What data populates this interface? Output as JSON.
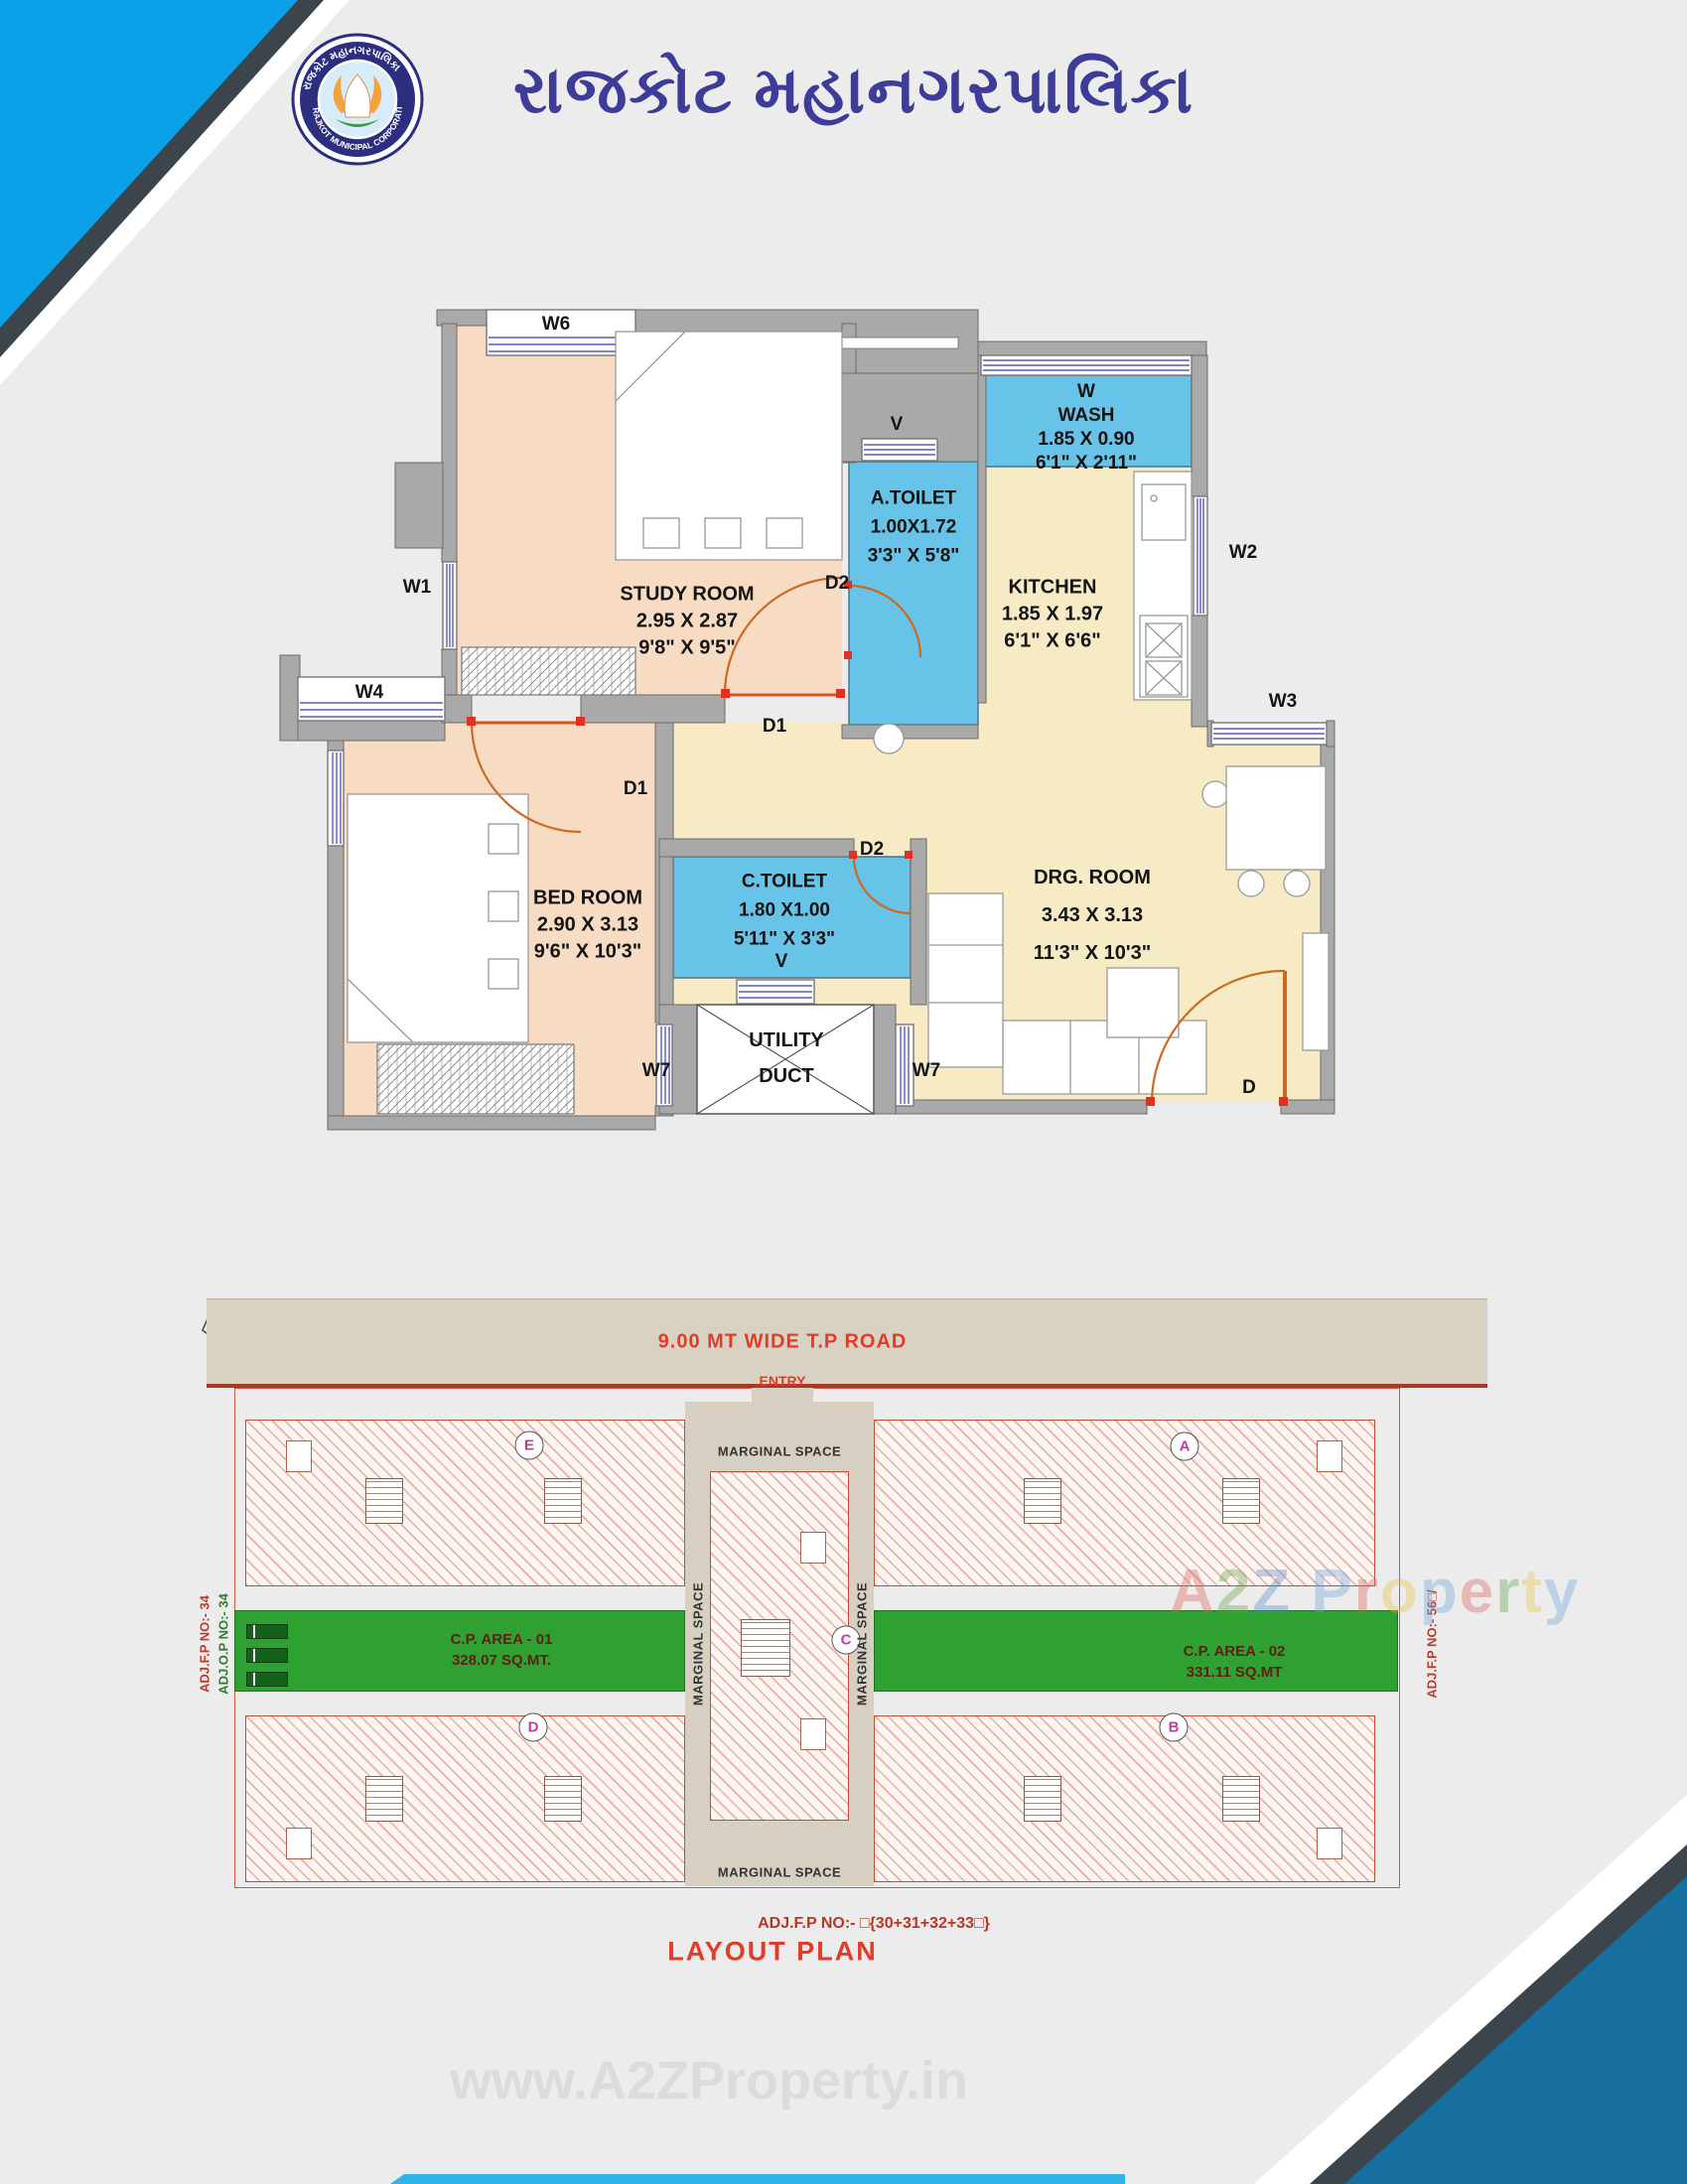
{
  "header": {
    "title": "રાજકોટ મહાનગરપાલિકા",
    "logo": {
      "arc_top": "રાજકોટ મહાનગરપાલિકા",
      "arc_bottom": "RAJKOT MUNICIPAL CORPORATION"
    }
  },
  "unit_plan": {
    "rooms": {
      "study": {
        "name": "STUDY ROOM",
        "dim_m": "2.95 X 2.87",
        "dim_ft": "9'8\" X 9'5\""
      },
      "bed": {
        "name": "BED ROOM",
        "dim_m": "2.90 X 3.13",
        "dim_ft": "9'6\" X 10'3\""
      },
      "a_toilet": {
        "name": "A.TOILET",
        "dim_m": "1.00X1.72",
        "dim_ft": "3'3\" X 5'8\""
      },
      "c_toilet": {
        "name": "C.TOILET",
        "dim_m": "1.80 X1.00",
        "dim_ft": "5'11\" X 3'3\""
      },
      "wash": {
        "tag": "W",
        "name": "WASH",
        "dim_m": "1.85 X 0.90",
        "dim_ft": "6'1\" X 2'11\""
      },
      "kitchen": {
        "name": "KITCHEN",
        "dim_m": "1.85 X 1.97",
        "dim_ft": "6'1\" X 6'6\""
      },
      "drg": {
        "name": "DRG. ROOM",
        "dim_m": "3.43 X 3.13",
        "dim_ft": "11'3\" X 10'3\""
      },
      "utility": {
        "line1": "UTILITY",
        "line2": "DUCT"
      }
    },
    "tags": {
      "w1": "W1",
      "w2": "W2",
      "w3": "W3",
      "w4": "W4",
      "w6": "W6",
      "w7": "W7",
      "v": "V",
      "d": "D",
      "d1": "D1",
      "d2": "D2"
    }
  },
  "layout_plan": {
    "road": "9.00 MT WIDE T.P ROAD",
    "entry": "ENTRY",
    "marginal": "MARGINAL SPACE",
    "cp1": {
      "line1": "C.P. AREA - 01",
      "line2": "328.07 SQ.MT."
    },
    "cp2": {
      "line1": "C.P. AREA - 02",
      "line2": "331.11 SQ.MT"
    },
    "adj_left_red": "ADJ.F.P NO:- 34",
    "adj_left_green": "ADJ.O.P NO:- 34",
    "adj_right": "ADJ.F.P NO:- 56□/",
    "adj_bottom": "ADJ.F.P NO:- □{30+31+32+33□}",
    "title": "LAYOUT PLAN",
    "blocks": {
      "a": "A",
      "b": "B",
      "c": "C",
      "d": "D",
      "e": "E"
    }
  },
  "watermark": {
    "brand": [
      {
        "ch": "A",
        "color": "#e0635e"
      },
      {
        "ch": "2",
        "color": "#69a84f"
      },
      {
        "ch": "Z",
        "color": "#5b8fd4"
      },
      {
        "ch": " ",
        "color": "#888888"
      },
      {
        "ch": "P",
        "color": "#6fa8dc"
      },
      {
        "ch": "r",
        "color": "#e0635e"
      },
      {
        "ch": "o",
        "color": "#e8c44a"
      },
      {
        "ch": "p",
        "color": "#6fa8dc"
      },
      {
        "ch": "e",
        "color": "#e0635e"
      },
      {
        "ch": "r",
        "color": "#69a84f"
      },
      {
        "ch": "t",
        "color": "#e8c44a"
      },
      {
        "ch": "y",
        "color": "#6fa8dc"
      }
    ],
    "site": "www.A2ZProperty.in"
  },
  "colors": {
    "accent_blue": "#0aa1e8",
    "dark_blue": "#166f9e",
    "title_blue": "#3d3c99",
    "red": "#e23c28",
    "green_area": "#2fa032",
    "toilet_blue": "#68c3e8",
    "room_peach": "#f8dbc3",
    "room_cream": "#f6ebc4",
    "wall_gray": "#a9a9a9"
  }
}
